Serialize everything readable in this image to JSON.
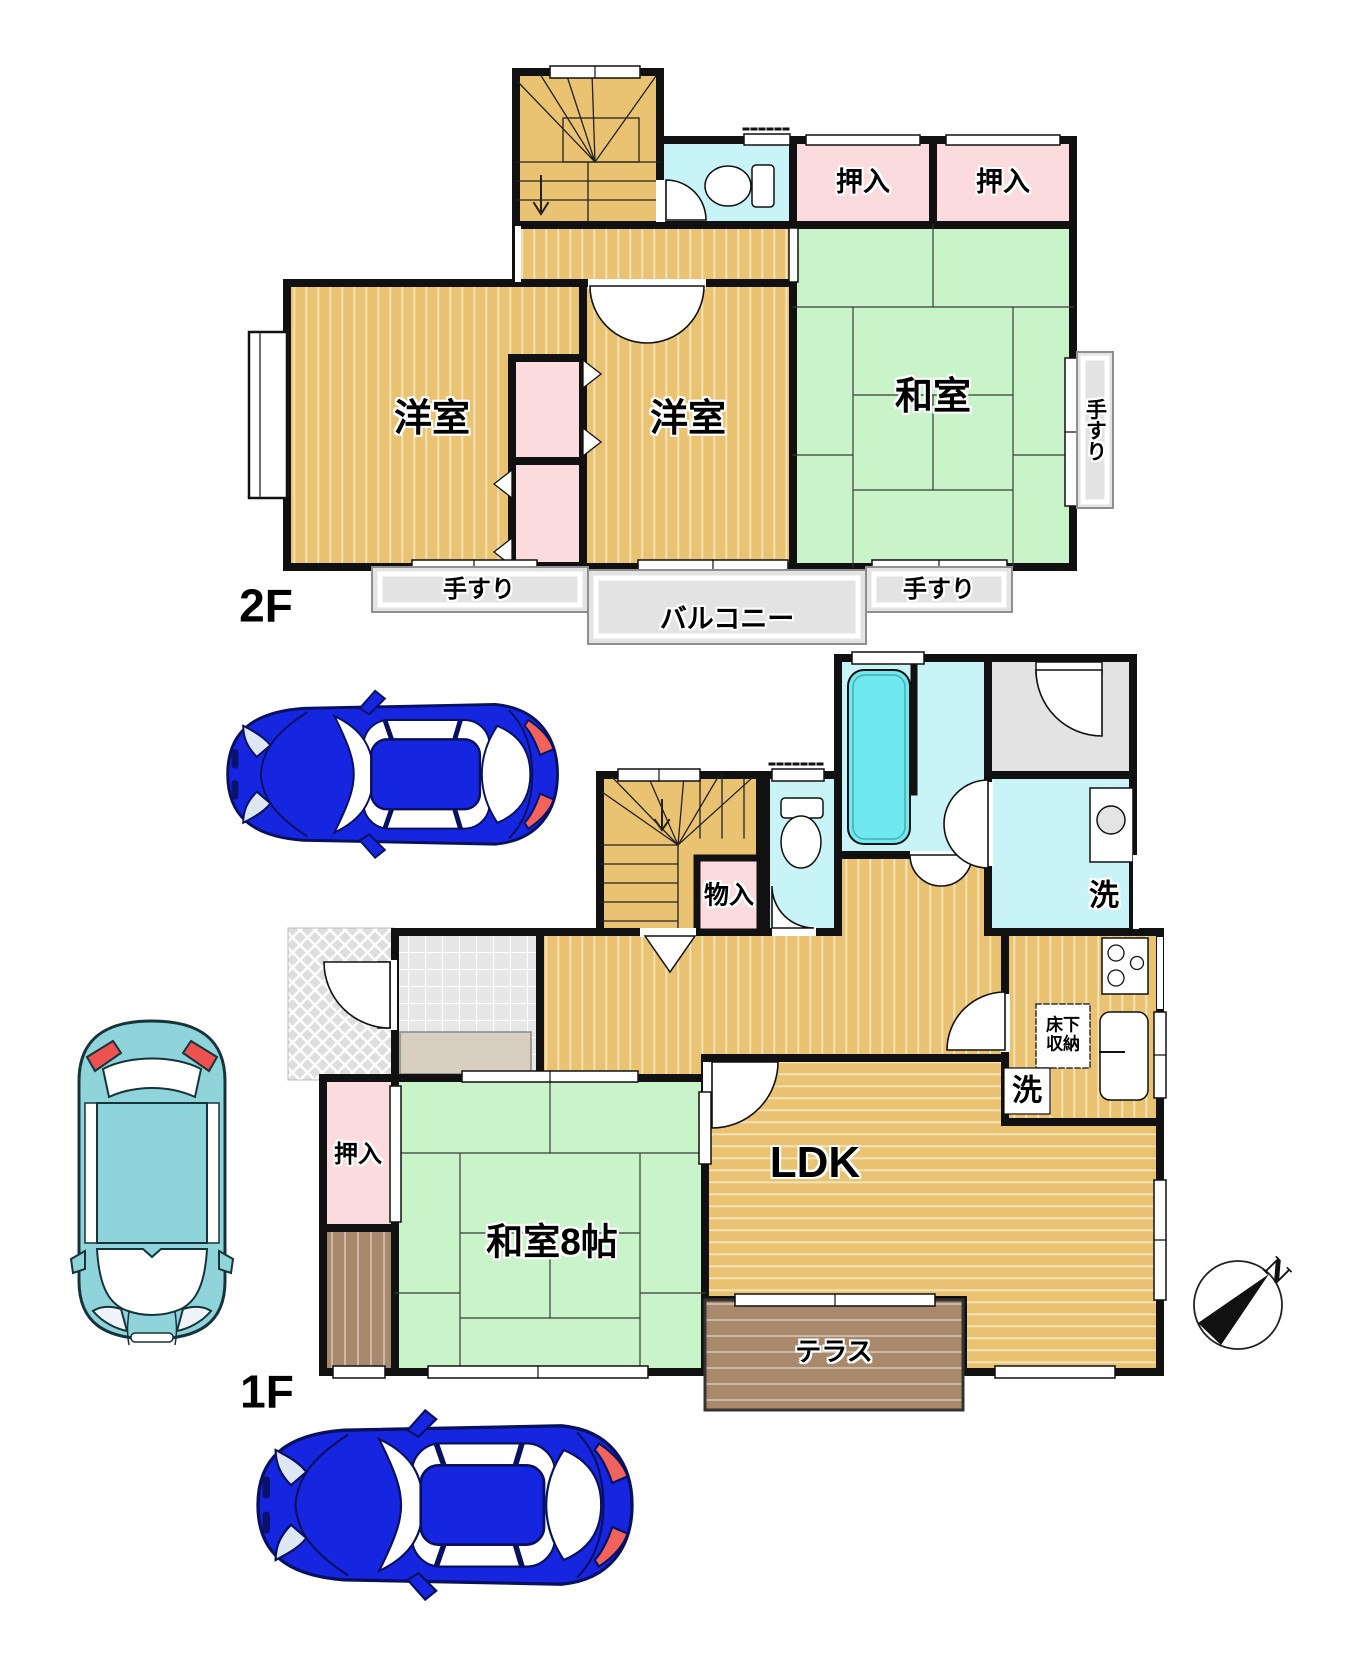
{
  "floor2": {
    "label": "2F",
    "rooms": {
      "western_left": "洋室",
      "western_right": "洋室",
      "japanese": "和室",
      "closet_a": "押入",
      "closet_b": "押入",
      "balcony": "バルコニー",
      "handrail_a": "手すり",
      "handrail_b": "手すり",
      "handrail_c": "手すり"
    }
  },
  "floor1": {
    "label": "1F",
    "rooms": {
      "ldk": "LDK",
      "japanese": "和室8帖",
      "closet": "押入",
      "storage": "物入",
      "terrace": "テラス",
      "laundry": "洗",
      "kitchen_wash": "洗",
      "underfloor_line1": "床下",
      "underfloor_line2": "収納"
    }
  },
  "compass": {
    "north": "N"
  },
  "colors": {
    "wall": "#111111",
    "wood_floor": "#e9c371",
    "tatami_green": "#c9f3c9",
    "closet_pink": "#fbdbdd",
    "wet_cyan": "#c9f4f7",
    "bathtub_cyan": "#70e8ef",
    "gray_area": "#e3e3e3",
    "terrace_brown": "#a8896c",
    "car_blue": "#1626e0",
    "car_teal": "#8fd4da"
  }
}
